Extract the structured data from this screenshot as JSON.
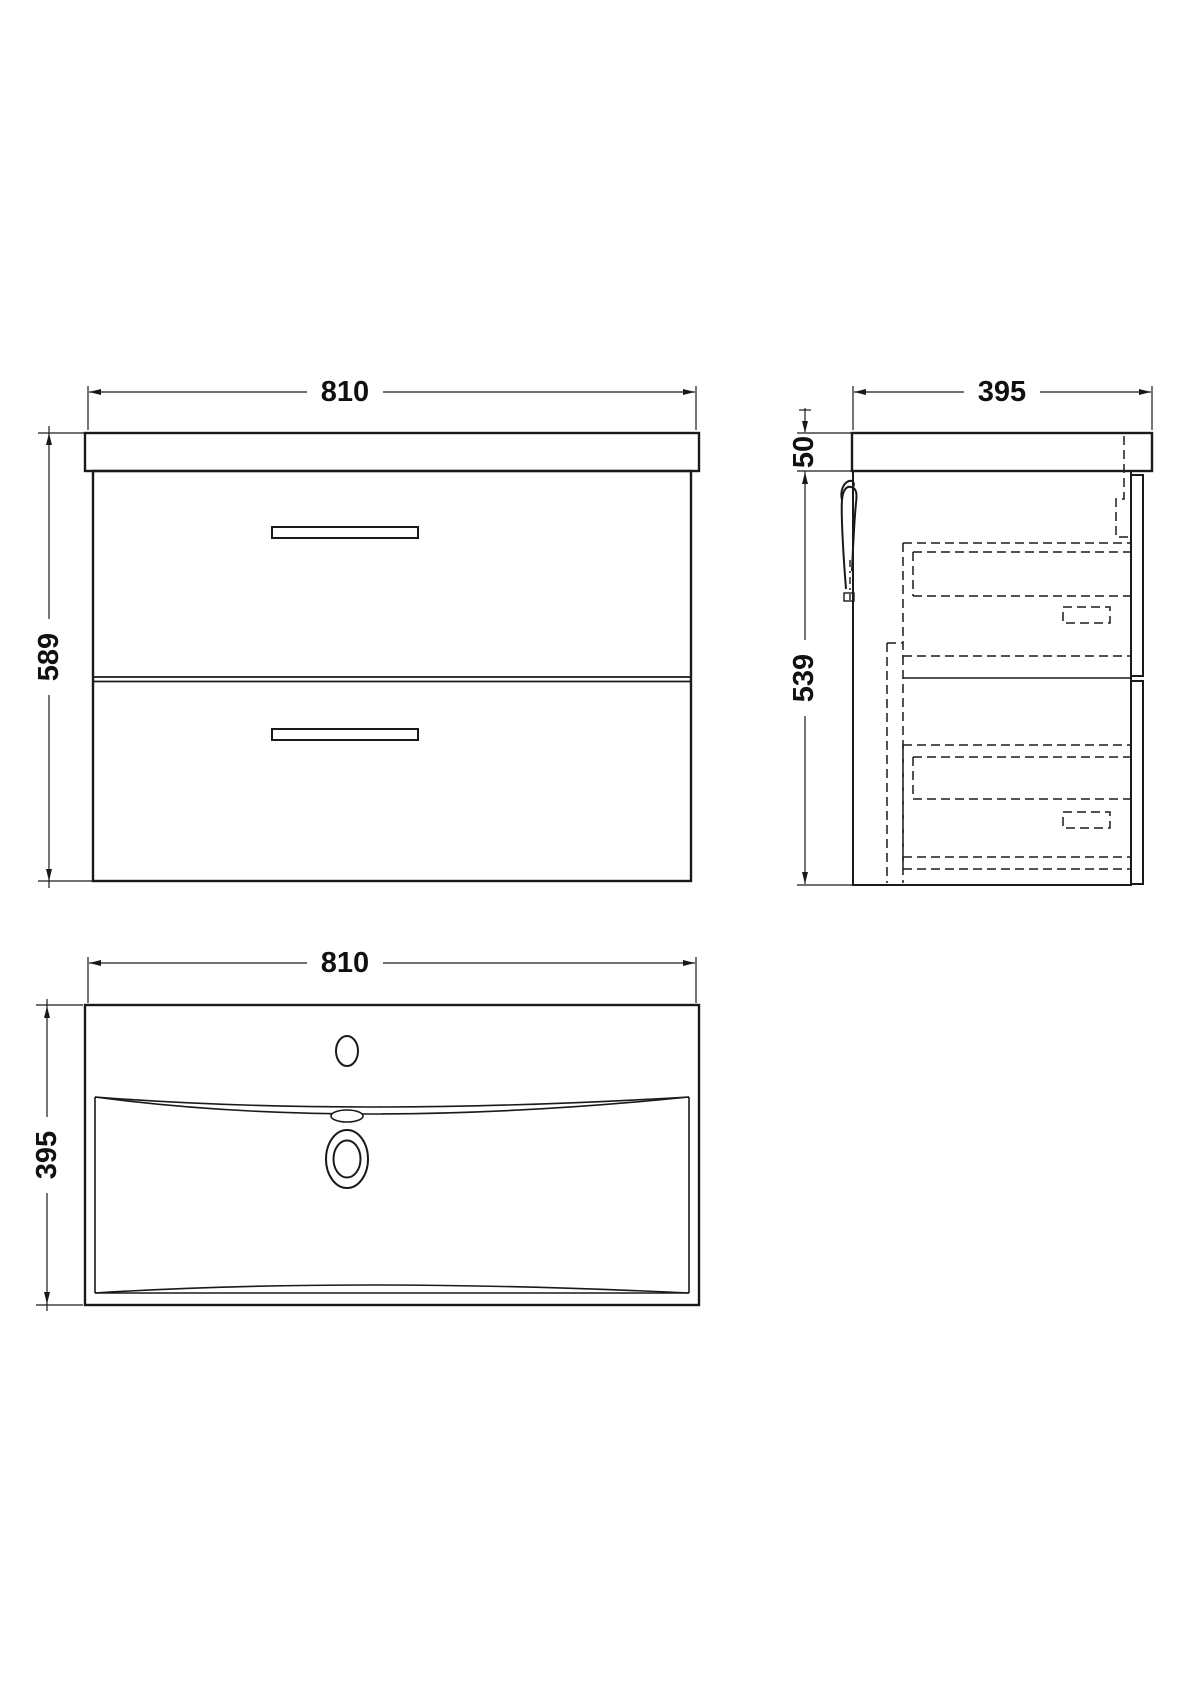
{
  "drawing": {
    "background": "#ffffff",
    "line_color": "#1a1a1a",
    "views": {
      "front": {
        "dim_width": "810",
        "dim_height": "589"
      },
      "side": {
        "dim_depth": "395",
        "dim_top_thickness": "50",
        "dim_body_height": "539"
      },
      "plan": {
        "dim_width": "810",
        "dim_depth": "395"
      }
    }
  }
}
